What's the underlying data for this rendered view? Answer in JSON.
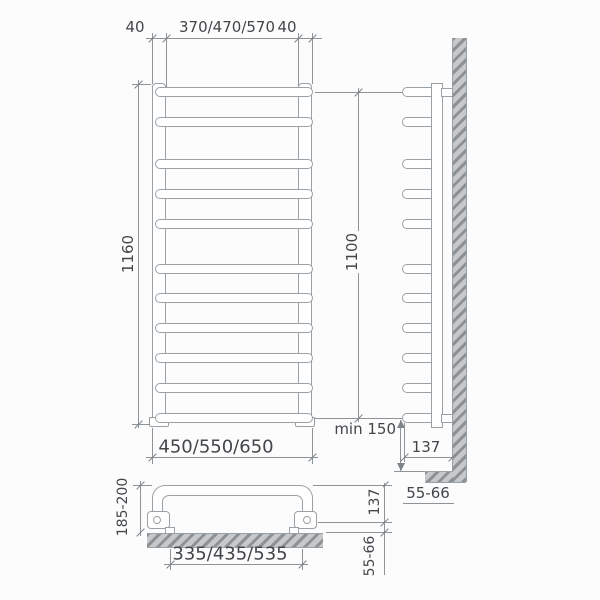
{
  "drawing": {
    "line_color": "#9aa1a6",
    "dim_line_color": "#8d9499",
    "text_color": "#42464a",
    "hatch_dark": "#8d9194",
    "hatch_light": "#c6c8c9"
  },
  "front_view": {
    "dim_top_left_offset": "40",
    "dim_top_center_width": "370/470/570",
    "dim_top_right_offset": "40",
    "dim_total_height": "1160",
    "dim_total_width": "450/550/650"
  },
  "side_view": {
    "dim_rung_span": "1100",
    "dim_floor_clearance": "min 150",
    "dim_depth_from_wall": "137",
    "dim_wall_gap": "55-66"
  },
  "top_view_detail": {
    "dim_depth_range": "185-200",
    "dim_bracket_spacing": "335/435/535",
    "dim_depth": "137",
    "dim_wall_gap": "55-66"
  },
  "rungs": {
    "count": 11,
    "grouping": "2-3-6",
    "y_centers": [
      92,
      122,
      164,
      194,
      224,
      269,
      298,
      328,
      358,
      388,
      418
    ]
  }
}
